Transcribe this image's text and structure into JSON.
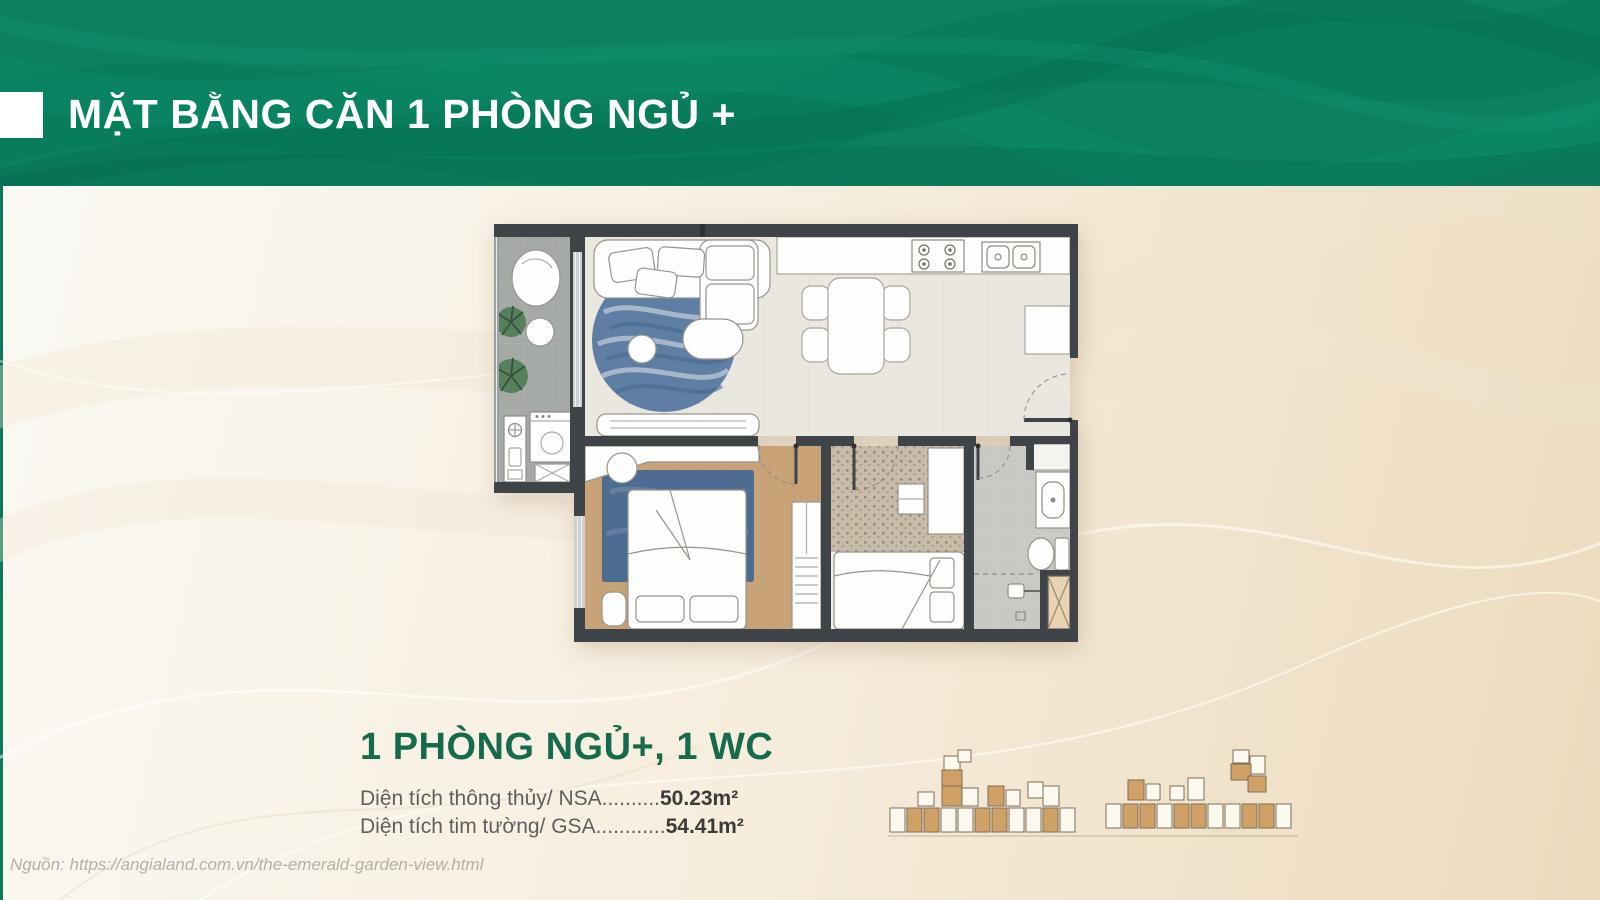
{
  "header": {
    "title": "MẶT BẰNG CĂN 1 PHÒNG NGỦ +"
  },
  "unit": {
    "name": "1 PHÒNG NGỦ+, 1 WC",
    "areas": [
      {
        "label": "Diện tích thông thủy/ NSA",
        "dots": "..........",
        "value": "50.23m²"
      },
      {
        "label": "Diện tích tim tường/ GSA",
        "dots": "............",
        "value": "54.41m²"
      }
    ]
  },
  "source": {
    "text": "Nguồn: https://angialand.com.vn/the-emerald-garden-view.html"
  },
  "colors": {
    "header_green": "#0b8160",
    "title_green": "#176b4d",
    "label_gray": "#5f5f5d",
    "value_dark": "#3b3b39",
    "wall": "#3f4449",
    "keyplan_tan": "#cfa166",
    "bg_left": "#fbf9f5",
    "bg_right": "#ecdabc"
  }
}
